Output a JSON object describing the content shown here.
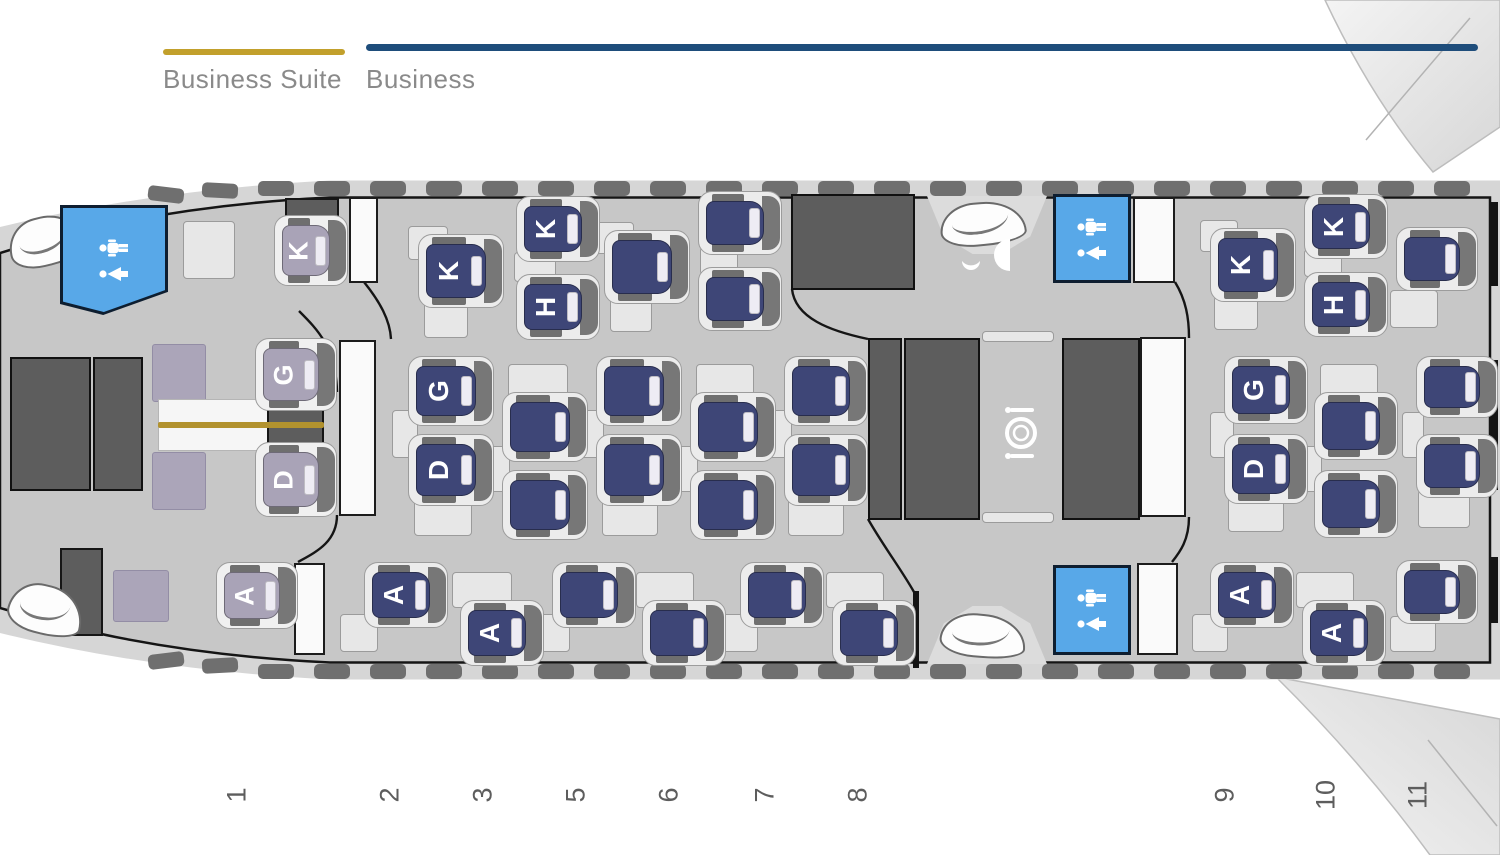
{
  "legend": {
    "items": [
      {
        "label": "Business Suite",
        "color": "#c2a02c",
        "line": [
          163,
          49,
          182,
          6
        ],
        "text_xy": [
          163,
          64
        ]
      },
      {
        "label": "Business",
        "color": "#1e4d7b",
        "line": [
          366,
          44,
          1112,
          7
        ],
        "text_xy": [
          366,
          64
        ]
      }
    ]
  },
  "colors": {
    "suite_seat": "#a9a3b7",
    "business_seat": "#3e4677",
    "lavatory_blue": "#58a8e8",
    "galley_gray": "#5d5d5d",
    "cabin_gray": "#c7c7c7",
    "fuselage_gray": "#d6d6d6",
    "gold_divider": "#b2922e"
  },
  "rows": [
    {
      "label": "1",
      "x": 237
    },
    {
      "label": "2",
      "x": 390
    },
    {
      "label": "3",
      "x": 483
    },
    {
      "label": "5",
      "x": 576
    },
    {
      "label": "6",
      "x": 669
    },
    {
      "label": "7",
      "x": 765
    },
    {
      "label": "8",
      "x": 858
    },
    {
      "label": "9",
      "x": 1225
    },
    {
      "label": "10",
      "x": 1326
    },
    {
      "label": "11",
      "x": 1418
    }
  ],
  "row_numbers_y": 795,
  "seats": [
    {
      "id": "1K",
      "label": "K",
      "type": "suite",
      "r": [
        282,
        225,
        48,
        51
      ]
    },
    {
      "id": "1G",
      "label": "G",
      "type": "suite",
      "r": [
        263,
        348,
        56,
        53
      ]
    },
    {
      "id": "1D",
      "label": "D",
      "type": "suite",
      "r": [
        263,
        452,
        56,
        55
      ]
    },
    {
      "id": "1A",
      "label": "A",
      "type": "suite",
      "r": [
        224,
        572,
        56,
        47
      ]
    },
    {
      "id": "2K",
      "label": "K",
      "type": "biz",
      "r": [
        426,
        244,
        60,
        54
      ]
    },
    {
      "id": "3K",
      "label": "K",
      "type": "biz",
      "r": [
        524,
        206,
        58,
        46
      ]
    },
    {
      "id": "3H",
      "label": "H",
      "type": "biz",
      "r": [
        524,
        284,
        58,
        46
      ]
    },
    {
      "id": "5K",
      "label": "",
      "type": "biz",
      "r": [
        612,
        240,
        60,
        54
      ]
    },
    {
      "id": "6K",
      "label": "",
      "type": "biz",
      "r": [
        706,
        201,
        58,
        44
      ]
    },
    {
      "id": "6H",
      "label": "",
      "type": "biz",
      "r": [
        706,
        277,
        58,
        44
      ]
    },
    {
      "id": "9K",
      "label": "K",
      "type": "biz",
      "r": [
        1218,
        238,
        60,
        54
      ]
    },
    {
      "id": "10K",
      "label": "K",
      "type": "biz",
      "r": [
        1312,
        204,
        58,
        45
      ]
    },
    {
      "id": "10H",
      "label": "H",
      "type": "biz",
      "r": [
        1312,
        282,
        58,
        45
      ]
    },
    {
      "id": "11K",
      "label": "",
      "type": "biz",
      "r": [
        1404,
        237,
        56,
        44
      ]
    },
    {
      "id": "2G",
      "label": "G",
      "type": "biz",
      "r": [
        416,
        366,
        60,
        50
      ]
    },
    {
      "id": "2D",
      "label": "D",
      "type": "biz",
      "r": [
        416,
        444,
        60,
        52
      ]
    },
    {
      "id": "3G",
      "label": "",
      "type": "biz",
      "r": [
        510,
        402,
        60,
        50
      ]
    },
    {
      "id": "3D",
      "label": "",
      "type": "biz",
      "r": [
        510,
        480,
        60,
        50
      ]
    },
    {
      "id": "5G",
      "label": "",
      "type": "biz",
      "r": [
        604,
        366,
        60,
        50
      ]
    },
    {
      "id": "5D",
      "label": "",
      "type": "biz",
      "r": [
        604,
        444,
        60,
        52
      ]
    },
    {
      "id": "6G",
      "label": "",
      "type": "biz",
      "r": [
        698,
        402,
        60,
        50
      ]
    },
    {
      "id": "6D",
      "label": "",
      "type": "biz",
      "r": [
        698,
        480,
        60,
        50
      ]
    },
    {
      "id": "7G",
      "label": "",
      "type": "biz",
      "r": [
        792,
        366,
        58,
        50
      ]
    },
    {
      "id": "7D",
      "label": "",
      "type": "biz",
      "r": [
        792,
        444,
        58,
        52
      ]
    },
    {
      "id": "9G",
      "label": "G",
      "type": "biz",
      "r": [
        1232,
        366,
        58,
        48
      ]
    },
    {
      "id": "9D",
      "label": "D",
      "type": "biz",
      "r": [
        1232,
        444,
        58,
        50
      ]
    },
    {
      "id": "10G",
      "label": "",
      "type": "biz",
      "r": [
        1322,
        402,
        58,
        48
      ]
    },
    {
      "id": "10D",
      "label": "",
      "type": "biz",
      "r": [
        1322,
        480,
        58,
        48
      ]
    },
    {
      "id": "11G",
      "label": "",
      "type": "biz",
      "r": [
        1424,
        366,
        56,
        42
      ]
    },
    {
      "id": "11D",
      "label": "",
      "type": "biz",
      "r": [
        1424,
        444,
        56,
        44
      ]
    },
    {
      "id": "2A",
      "label": "A",
      "type": "biz",
      "r": [
        372,
        572,
        58,
        46
      ]
    },
    {
      "id": "3A",
      "label": "A",
      "type": "biz",
      "r": [
        468,
        610,
        58,
        46
      ]
    },
    {
      "id": "5A",
      "label": "",
      "type": "biz",
      "r": [
        560,
        572,
        58,
        46
      ]
    },
    {
      "id": "6A",
      "label": "",
      "type": "biz",
      "r": [
        650,
        610,
        58,
        46
      ]
    },
    {
      "id": "7A",
      "label": "",
      "type": "biz",
      "r": [
        748,
        572,
        58,
        46
      ]
    },
    {
      "id": "8A",
      "label": "",
      "type": "biz",
      "r": [
        840,
        610,
        58,
        46
      ]
    },
    {
      "id": "9A",
      "label": "A",
      "type": "biz",
      "r": [
        1218,
        572,
        58,
        46
      ]
    },
    {
      "id": "10A",
      "label": "A",
      "type": "biz",
      "r": [
        1310,
        610,
        58,
        46
      ]
    },
    {
      "id": "11A",
      "label": "",
      "type": "biz",
      "r": [
        1404,
        570,
        56,
        44
      ]
    }
  ],
  "panels": [
    {
      "fill": "light",
      "r": [
        183,
        221,
        52,
        58
      ]
    },
    {
      "fill": "dark",
      "r": [
        285,
        198,
        54,
        26
      ]
    },
    {
      "fill": "white",
      "r": [
        349,
        197,
        29,
        86
      ]
    },
    {
      "fill": "lavender",
      "r": [
        152,
        344,
        54,
        58
      ]
    },
    {
      "fill": "lavender",
      "r": [
        152,
        452,
        54,
        58
      ]
    },
    {
      "fill": "table",
      "r": [
        158,
        399,
        164,
        52
      ]
    },
    {
      "fill": "dark",
      "r": [
        267,
        399,
        57,
        52
      ]
    },
    {
      "fill": "gold",
      "r": [
        158,
        422,
        166,
        6
      ]
    },
    {
      "fill": "white",
      "r": [
        339,
        340,
        37,
        176
      ]
    },
    {
      "fill": "lavender",
      "r": [
        113,
        570,
        56,
        52
      ]
    },
    {
      "fill": "dark",
      "r": [
        60,
        548,
        43,
        88
      ]
    },
    {
      "fill": "white",
      "r": [
        294,
        563,
        31,
        92
      ]
    },
    {
      "fill": "galley",
      "r": [
        10,
        357,
        81,
        134
      ]
    },
    {
      "fill": "galley",
      "r": [
        93,
        357,
        50,
        134
      ]
    },
    {
      "fill": "galley",
      "r": [
        791,
        194,
        124,
        96
      ]
    },
    {
      "fill": "galley",
      "r": [
        868,
        338,
        34,
        182
      ]
    },
    {
      "fill": "galley",
      "r": [
        904,
        338,
        76,
        182
      ]
    },
    {
      "fill": "galley",
      "r": [
        1062,
        338,
        78,
        182
      ]
    },
    {
      "fill": "light",
      "r": [
        982,
        331,
        72,
        11
      ]
    },
    {
      "fill": "light",
      "r": [
        982,
        512,
        72,
        11
      ]
    },
    {
      "fill": "black",
      "r": [
        913,
        591,
        6,
        77
      ]
    },
    {
      "fill": "white",
      "r": [
        1133,
        197,
        42,
        86
      ]
    },
    {
      "fill": "white",
      "r": [
        1140,
        337,
        46,
        180
      ]
    },
    {
      "fill": "white",
      "r": [
        1137,
        563,
        41,
        92
      ]
    },
    {
      "fill": "black",
      "r": [
        1491,
        202,
        7,
        84
      ]
    },
    {
      "fill": "black",
      "r": [
        1491,
        360,
        7,
        130
      ]
    },
    {
      "fill": "black",
      "r": [
        1491,
        557,
        7,
        66
      ]
    },
    {
      "fill": "light",
      "r": [
        408,
        226,
        40,
        34
      ]
    },
    {
      "fill": "light",
      "r": [
        424,
        302,
        44,
        36
      ]
    },
    {
      "fill": "light",
      "r": [
        514,
        252,
        42,
        30
      ]
    },
    {
      "fill": "light",
      "r": [
        596,
        222,
        38,
        32
      ]
    },
    {
      "fill": "light",
      "r": [
        610,
        298,
        42,
        34
      ]
    },
    {
      "fill": "light",
      "r": [
        700,
        247,
        38,
        28
      ]
    },
    {
      "fill": "light",
      "r": [
        1200,
        220,
        38,
        32
      ]
    },
    {
      "fill": "light",
      "r": [
        1214,
        296,
        44,
        34
      ]
    },
    {
      "fill": "light",
      "r": [
        1304,
        249,
        38,
        28
      ]
    },
    {
      "fill": "light",
      "r": [
        1390,
        290,
        48,
        38
      ]
    },
    {
      "fill": "light",
      "r": [
        392,
        410,
        26,
        48
      ]
    },
    {
      "fill": "light",
      "r": [
        414,
        498,
        58,
        38
      ]
    },
    {
      "fill": "light",
      "r": [
        508,
        364,
        60,
        36
      ]
    },
    {
      "fill": "light",
      "r": [
        488,
        446,
        22,
        46
      ]
    },
    {
      "fill": "light",
      "r": [
        580,
        410,
        24,
        48
      ]
    },
    {
      "fill": "light",
      "r": [
        602,
        498,
        56,
        38
      ]
    },
    {
      "fill": "light",
      "r": [
        696,
        364,
        58,
        36
      ]
    },
    {
      "fill": "light",
      "r": [
        676,
        446,
        22,
        46
      ]
    },
    {
      "fill": "light",
      "r": [
        768,
        410,
        24,
        48
      ]
    },
    {
      "fill": "light",
      "r": [
        788,
        498,
        56,
        38
      ]
    },
    {
      "fill": "light",
      "r": [
        1210,
        412,
        24,
        46
      ]
    },
    {
      "fill": "light",
      "r": [
        1228,
        496,
        56,
        36
      ]
    },
    {
      "fill": "light",
      "r": [
        1320,
        364,
        58,
        36
      ]
    },
    {
      "fill": "light",
      "r": [
        1300,
        446,
        22,
        46
      ]
    },
    {
      "fill": "light",
      "r": [
        1402,
        412,
        22,
        46
      ]
    },
    {
      "fill": "light",
      "r": [
        1418,
        490,
        52,
        38
      ]
    },
    {
      "fill": "light",
      "r": [
        340,
        614,
        38,
        38
      ]
    },
    {
      "fill": "light",
      "r": [
        452,
        572,
        60,
        36
      ]
    },
    {
      "fill": "light",
      "r": [
        534,
        614,
        36,
        38
      ]
    },
    {
      "fill": "light",
      "r": [
        636,
        572,
        58,
        36
      ]
    },
    {
      "fill": "light",
      "r": [
        722,
        614,
        36,
        38
      ]
    },
    {
      "fill": "light",
      "r": [
        826,
        572,
        58,
        36
      ]
    },
    {
      "fill": "light",
      "r": [
        1192,
        614,
        36,
        38
      ]
    },
    {
      "fill": "light",
      "r": [
        1296,
        572,
        58,
        36
      ]
    },
    {
      "fill": "light",
      "r": [
        1390,
        616,
        46,
        36
      ]
    }
  ],
  "lavatories": [
    {
      "name": "lavatory-front",
      "r": [
        63,
        208,
        102,
        104
      ],
      "clipped": true
    },
    {
      "name": "lavatory-mid-top",
      "r": [
        1053,
        194,
        78,
        89
      ],
      "clipped": false
    },
    {
      "name": "lavatory-mid-bottom",
      "r": [
        1053,
        565,
        78,
        90
      ],
      "clipped": false
    }
  ],
  "door_wells": [
    {
      "r": [
        927,
        196,
        120,
        58
      ],
      "flip": false
    },
    {
      "r": [
        927,
        606,
        120,
        58
      ],
      "flip": true
    }
  ],
  "door_leaves": [
    {
      "r": [
        8,
        216,
        76,
        50
      ],
      "rot": -14
    },
    {
      "r": [
        8,
        585,
        76,
        50
      ],
      "rot": 14
    },
    {
      "r": [
        940,
        202,
        86,
        44
      ],
      "rot": -5
    },
    {
      "r": [
        940,
        614,
        86,
        44
      ],
      "rot": 5
    }
  ],
  "icons": [
    {
      "type": "bar-icon",
      "r": [
        958,
        232,
        56,
        50
      ]
    },
    {
      "type": "dining-icon",
      "r": [
        996,
        404,
        50,
        58
      ]
    }
  ]
}
